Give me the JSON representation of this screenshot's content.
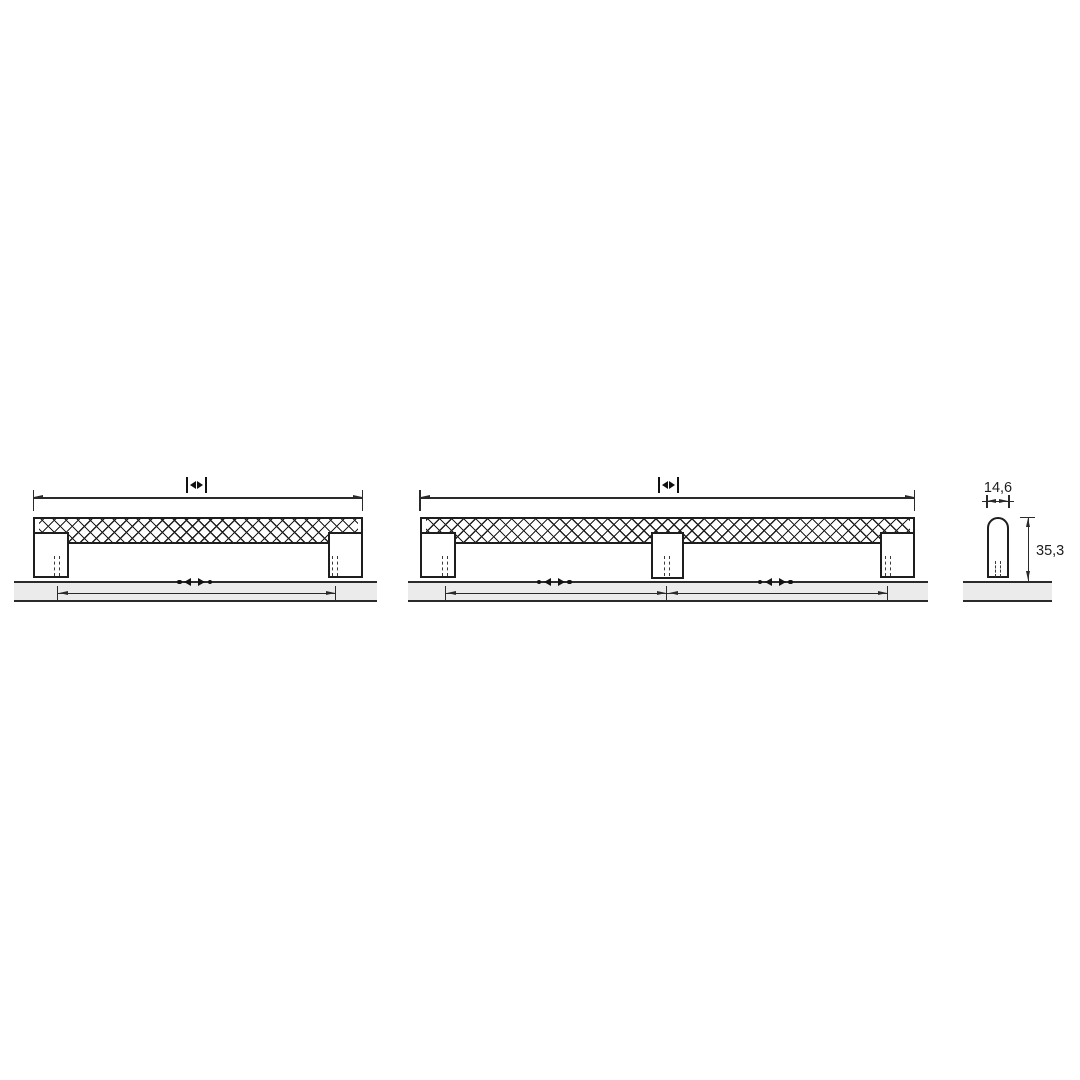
{
  "colors": {
    "background": "#ffffff",
    "line": "#1e1e1e",
    "dimension_line": "#2a2a2a",
    "panel_fill": "#ebebeb",
    "text": "#1d1d1d"
  },
  "profile_view": {
    "width_label": "14,6",
    "height_label": "35,3"
  },
  "icons": {
    "overall_length_placeholder": "bar-arrowleft-arrowright-bar",
    "center_distance_placeholder": "dot-arrowleft-arrowright-dot"
  }
}
